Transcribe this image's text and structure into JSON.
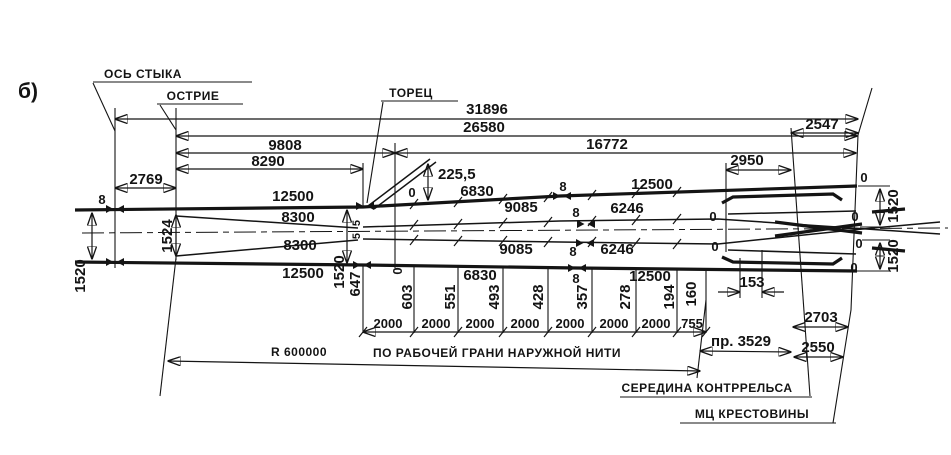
{
  "figure_label": "б)",
  "callouts": {
    "joint_axis": "ОСЬ СТЫКА",
    "point_tip": "ОСТРИЕ",
    "end_face": "ТОРЕЦ",
    "guard_rail_middle": "СЕРЕДИНА КОНТРРЕЛЬСА",
    "frog_math_center": "МЦ КРЕСТОВИНЫ",
    "radius": "R 600000",
    "radius_note": "ПО РАБОЧЕЙ ГРАНИ НАРУЖНОЙ НИТИ"
  },
  "dims": {
    "overall": "31896",
    "main": "26580",
    "front": "9808",
    "rear": "16772",
    "front_inner": "8290",
    "joint_to_point": "2769",
    "tail": "2547",
    "guard_len": "2950",
    "bend_offset": "225,5",
    "step": "2000",
    "step_last": "755",
    "straight": "пр. 3529",
    "guard_end": "153",
    "tail_upper": "2703",
    "tail_lower": "2550",
    "gauge": "1520",
    "gauge_point": "1524",
    "joint_gap": "8",
    "half_gap": "5",
    "zero": "0"
  },
  "rails": {
    "frame_rail": "12500",
    "switch_rail": "8300",
    "closure1": "6830",
    "closure2": "9085",
    "closure3": "6246"
  },
  "ordinates": {
    "o647": "647",
    "o603": "603",
    "o551": "551",
    "o493": "493",
    "o428": "428",
    "o357": "357",
    "o278": "278",
    "o194": "194",
    "o160": "160"
  }
}
